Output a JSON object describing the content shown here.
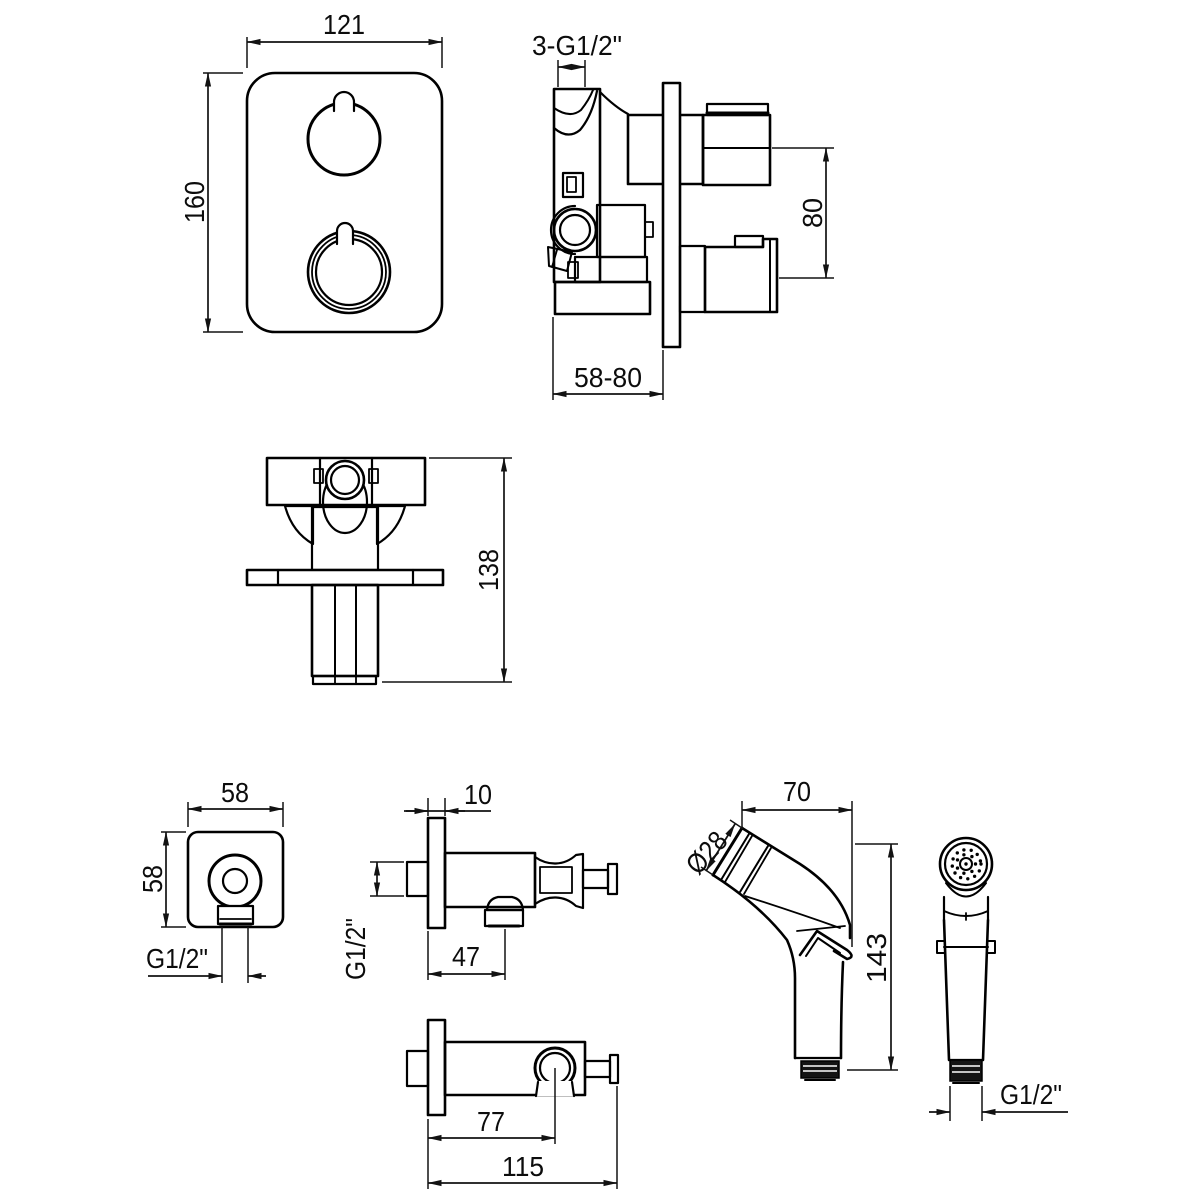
{
  "page": {
    "background": "#ffffff",
    "line_color": "#000000"
  },
  "views": {
    "trim_plate_front": {
      "dims": {
        "width": "121",
        "height": "160"
      }
    },
    "valve_body_side": {
      "dims": {
        "connections": "3-G1/2\"",
        "port_spacing": "80",
        "install_depth": "58-80"
      }
    },
    "valve_body_top": {
      "dims": {
        "length": "138"
      }
    },
    "wall_outlet_front": {
      "dims": {
        "width": "58",
        "height": "58",
        "outlet_thread": "G1/2\""
      }
    },
    "wall_bracket_side": {
      "dims": {
        "flange_thickness": "10",
        "inlet_thread": "G1/2\"",
        "outlet_offset": "47"
      }
    },
    "wall_bracket_top": {
      "dims": {
        "holder_offset": "77",
        "overall_length": "115"
      }
    },
    "handshower_side": {
      "dims": {
        "head_length": "70",
        "head_diameter": "Ø28",
        "overall_height": "143"
      }
    },
    "handshower_front": {
      "dims": {
        "connection_thread": "G1/2\""
      }
    }
  }
}
